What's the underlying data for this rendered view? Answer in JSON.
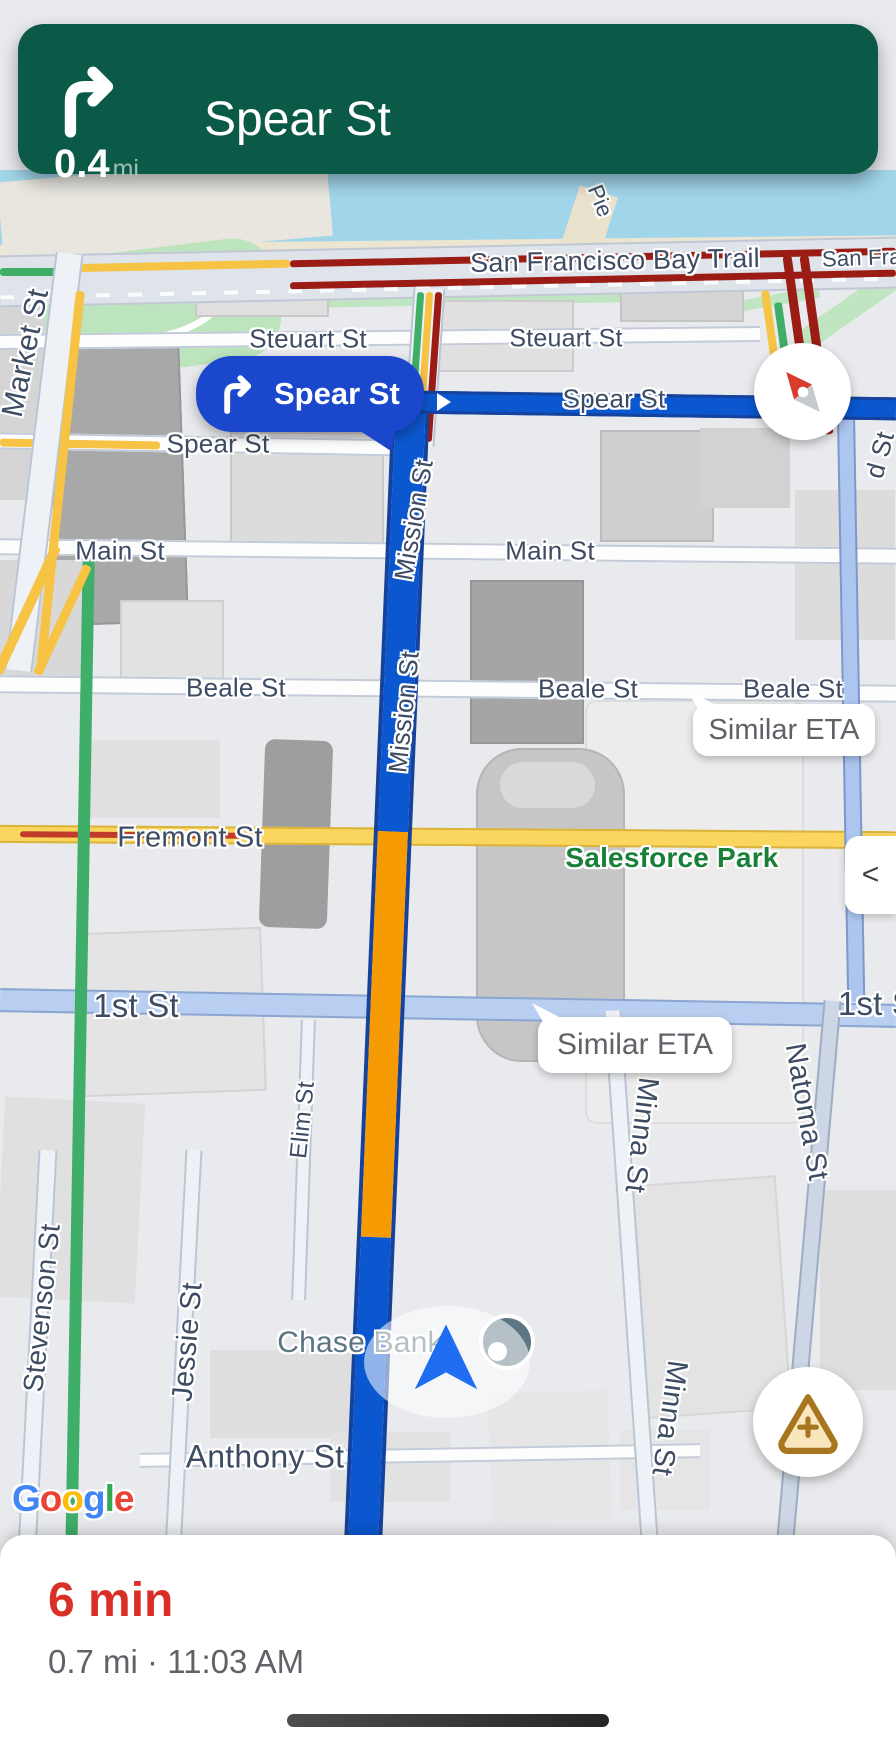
{
  "navigation_banner": {
    "maneuver_icon": "turn-right-arrow",
    "distance_value": "0.4",
    "distance_unit": "mi",
    "instruction": "Spear St",
    "background": "#0b5a48"
  },
  "maneuver_callout": {
    "icon": "turn-right-arrow",
    "label": "Spear St",
    "background": "#1b47cc"
  },
  "eta_callouts": [
    {
      "label": "Similar ETA"
    },
    {
      "label": "Similar ETA"
    }
  ],
  "controls": {
    "compass_icon": "compass-needle",
    "collapse_label": "<",
    "report_icon": "warning-triangle-plus"
  },
  "map": {
    "route_color": "#0b57d0",
    "route_traffic_color": "#f79b05",
    "street_labels": [
      {
        "text": "Pie"
      },
      {
        "text": "San Francisco Bay Trail"
      },
      {
        "text": "San Fran"
      },
      {
        "text": "Steuart St"
      },
      {
        "text": "Steuart St"
      },
      {
        "text": "Market St"
      },
      {
        "text": "Spear St"
      },
      {
        "text": "Spear St"
      },
      {
        "text": "Main St"
      },
      {
        "text": "Main St"
      },
      {
        "text": "Beale St"
      },
      {
        "text": "Beale St"
      },
      {
        "text": "Beale St"
      },
      {
        "text": "Fremont St"
      },
      {
        "text": "Mission St"
      },
      {
        "text": "Mission St"
      },
      {
        "text": "1st St"
      },
      {
        "text": "1st S"
      },
      {
        "text": "Natoma St"
      },
      {
        "text": "Minna St"
      },
      {
        "text": "Minna St"
      },
      {
        "text": "Elim St"
      },
      {
        "text": "Jessie St"
      },
      {
        "text": "Stevenson St"
      },
      {
        "text": "Anthony St"
      },
      {
        "text": "d St"
      }
    ],
    "poi_labels": [
      {
        "text": "Chase Bank"
      },
      {
        "text": "Salesforce Park"
      }
    ],
    "google_logo": [
      "G",
      "o",
      "o",
      "g",
      "l",
      "e"
    ]
  },
  "bottom_sheet": {
    "eta": "6 min",
    "eta_color": "#da2f27",
    "details": "0.7 mi · 11:03 AM"
  }
}
